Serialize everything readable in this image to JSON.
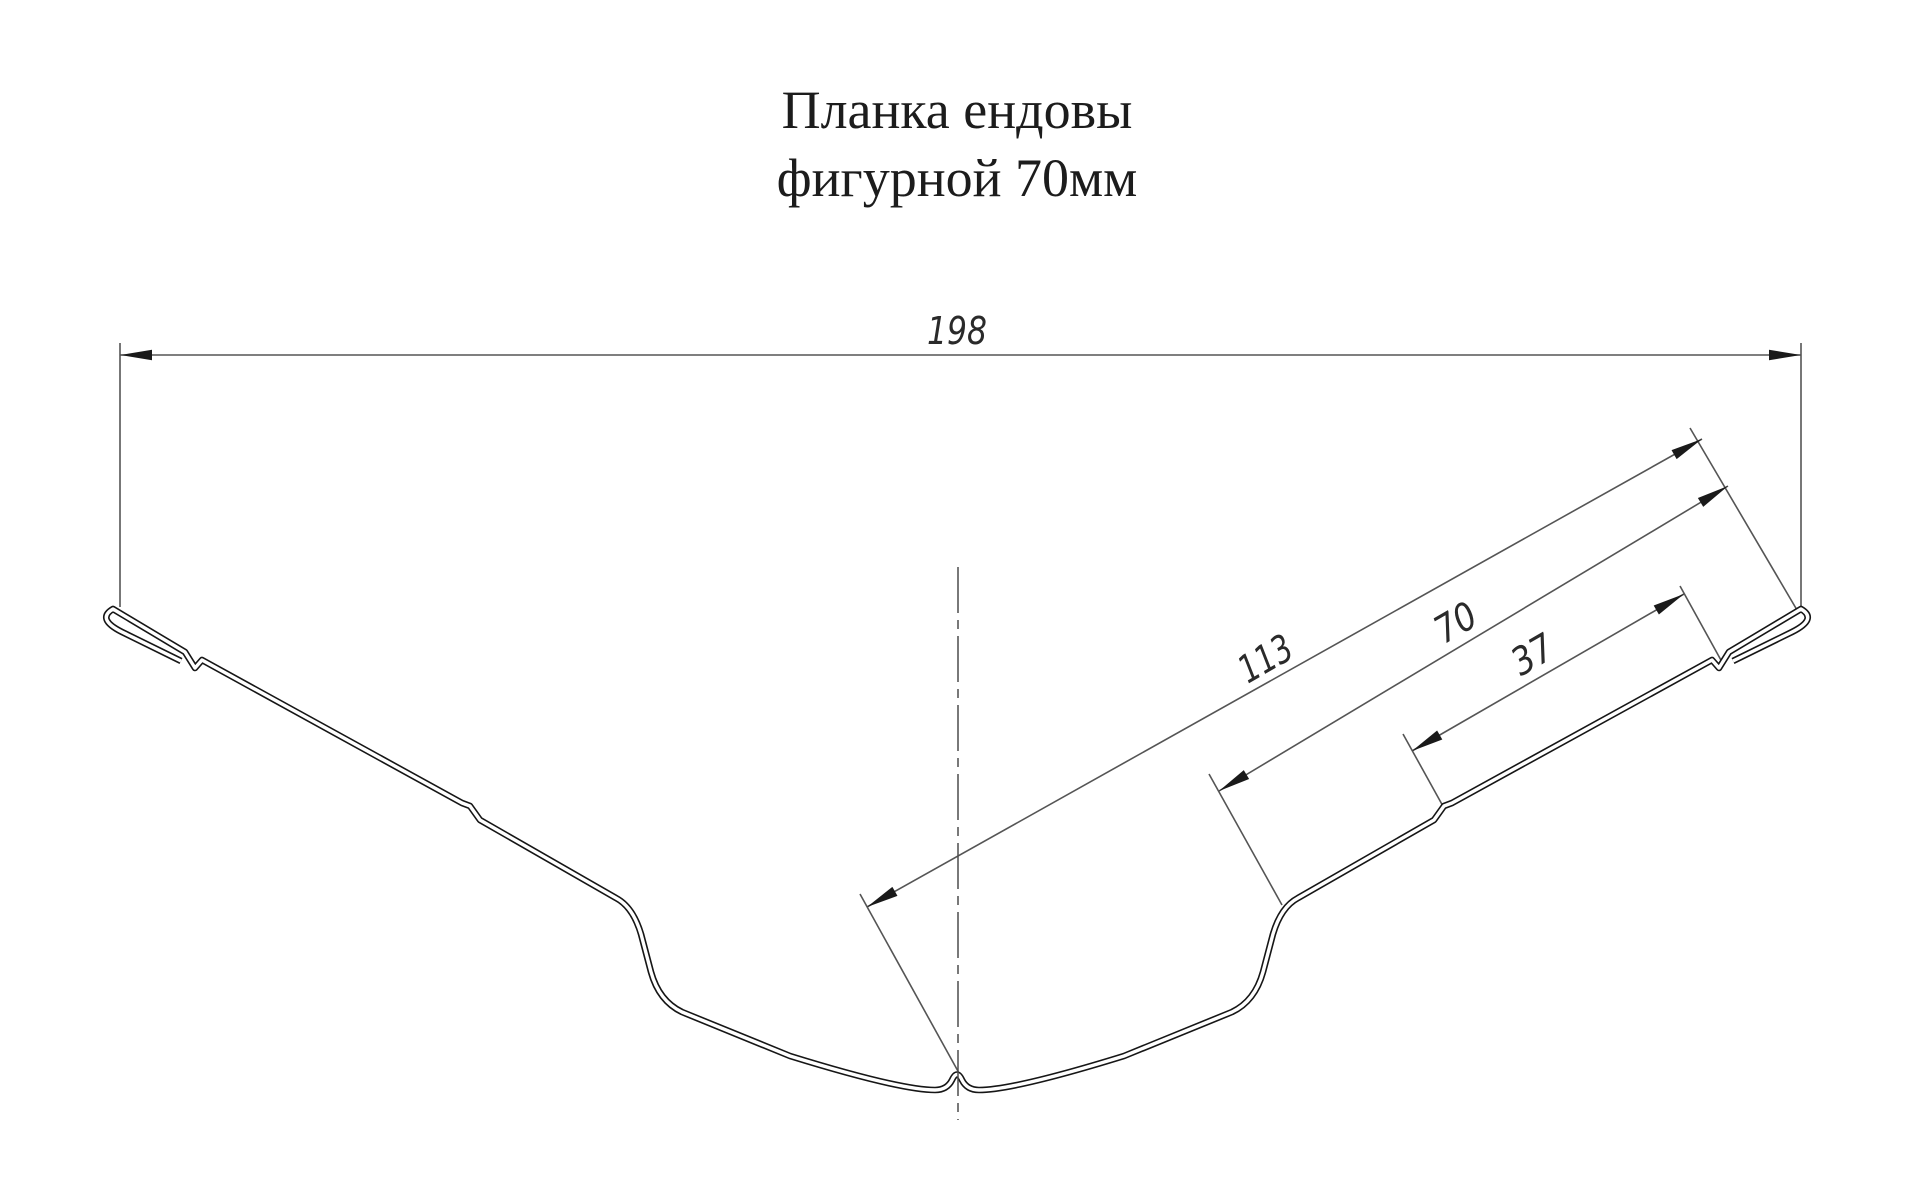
{
  "title": {
    "line1": "Планка ендовы",
    "line2": "фигурной 70мм"
  },
  "dimensions": {
    "overall_width_mm": "198",
    "center_to_edge_mm": "113",
    "bend_to_edge_mm": "70",
    "rib_to_edge_mm": "37"
  },
  "drawing": {
    "profile_line_color": "#161616",
    "dimension_line_color": "#555555",
    "background_color": "#ffffff"
  }
}
